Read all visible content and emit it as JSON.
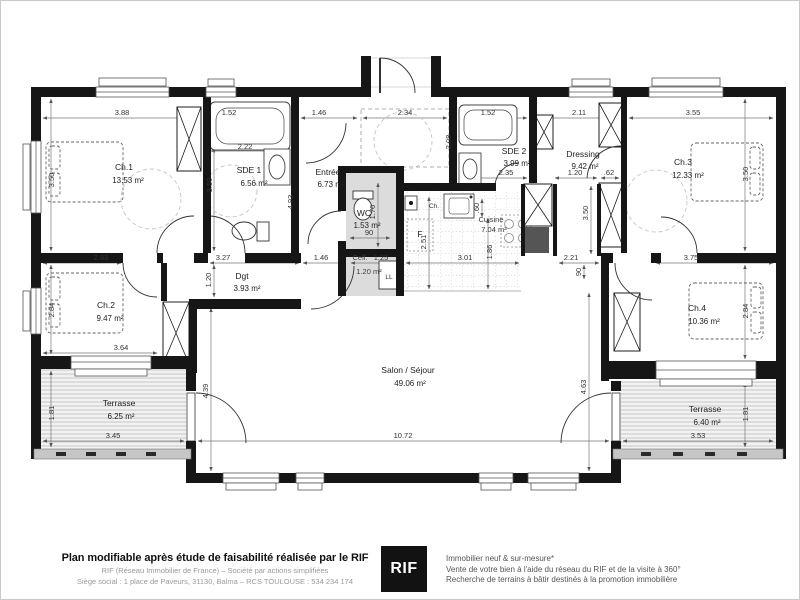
{
  "plan": {
    "rooms": {
      "ch1": {
        "name": "Ch.1",
        "area": "13.53 m²"
      },
      "sde1": {
        "name": "SDE 1",
        "area": "6.56 m²"
      },
      "entree": {
        "name": "Entrée",
        "area": "6.73 m²"
      },
      "wc": {
        "name": "WC",
        "area": "1.53 m²"
      },
      "sde2": {
        "name": "SDE 2",
        "area": "3.99 m²"
      },
      "dressing": {
        "name": "Dressing",
        "area": "9.42 m²"
      },
      "ch3": {
        "name": "Ch.3",
        "area": "12.33 m²"
      },
      "ch2": {
        "name": "Ch.2",
        "area": "9.47 m²"
      },
      "dgt": {
        "name": "Dgt",
        "area": "3.93 m²"
      },
      "cell": {
        "name": "Cell.",
        "area": "1.20 m²"
      },
      "cuisine": {
        "name": "Cuisine",
        "area": "7.04 m²"
      },
      "ch4": {
        "name": "Ch.4",
        "area": "10.36 m²"
      },
      "salon": {
        "name": "Salon / Séjour",
        "area": "49.06 m²"
      },
      "terrasse_left": {
        "name": "Terrasse",
        "area": "6.25 m²"
      },
      "terrasse_right": {
        "name": "Terrasse",
        "area": "6.40 m²"
      }
    },
    "appliances": {
      "fridge": "F",
      "washer": "LL",
      "heater": "Ch."
    },
    "dims": {
      "ch1_top": "3.88",
      "sde1_top": "1.52",
      "entree_top": "1.46",
      "closet_top": "2.34",
      "sde2_top": "1.52",
      "dressing_top": "2.11",
      "ch3_top": "3.55",
      "sde1_inner": "2.22",
      "sde2_width": "2.35",
      "dressing_door": "1.20",
      "dressing_stub": ".62",
      "wc_door": "90",
      "ch1_bottom": "2.83",
      "sde1_bottom": "3.27",
      "hall_width": "1.46",
      "cell_width": "1.25",
      "kitchen_width": "3.01",
      "corridor_width": "2.21",
      "ch4_top": "3.75",
      "ch2_bottom": "3.64",
      "terrl_bottom": "3.45",
      "salon_width": "10.72",
      "terrr_bottom": "3.53",
      "ch1_left": "3.50",
      "ch2_left": "2.84",
      "terrl_left": "1.81",
      "sde1_height": "3.50",
      "entree_height": "4.93",
      "wc_height": "1.70",
      "sde2_height": "2.08",
      "fridge_height": "2.51",
      "counter_depth": ".60",
      "kitchen_open": "1.86",
      "dressing_height": "3.50",
      "corridor_door": "90",
      "ch3_right": "3.50",
      "ch4_right": "2.84",
      "terrr_right": "1.81",
      "dgt_height": "1.20",
      "salon_left": "4.39",
      "salon_right": "4.63"
    }
  },
  "footer": {
    "headline": "Plan modifiable après étude de faisabilité réalisée par le RIF",
    "line2": "RIF (Réseau Immobilier de France) – Société par actions simplifiées",
    "line3": "Siège social : 1 place de Paveurs, 31130, Balma – RCS TOULOUSE : 534 234 174",
    "logo": "RIF",
    "services": [
      "Immobilier neuf & sur-mesure*",
      "Vente de votre bien à l'aide du réseau du RIF et de la visite à 360°",
      "Recherche de terrains à bâtir destinés à la promotion immobilière"
    ]
  }
}
